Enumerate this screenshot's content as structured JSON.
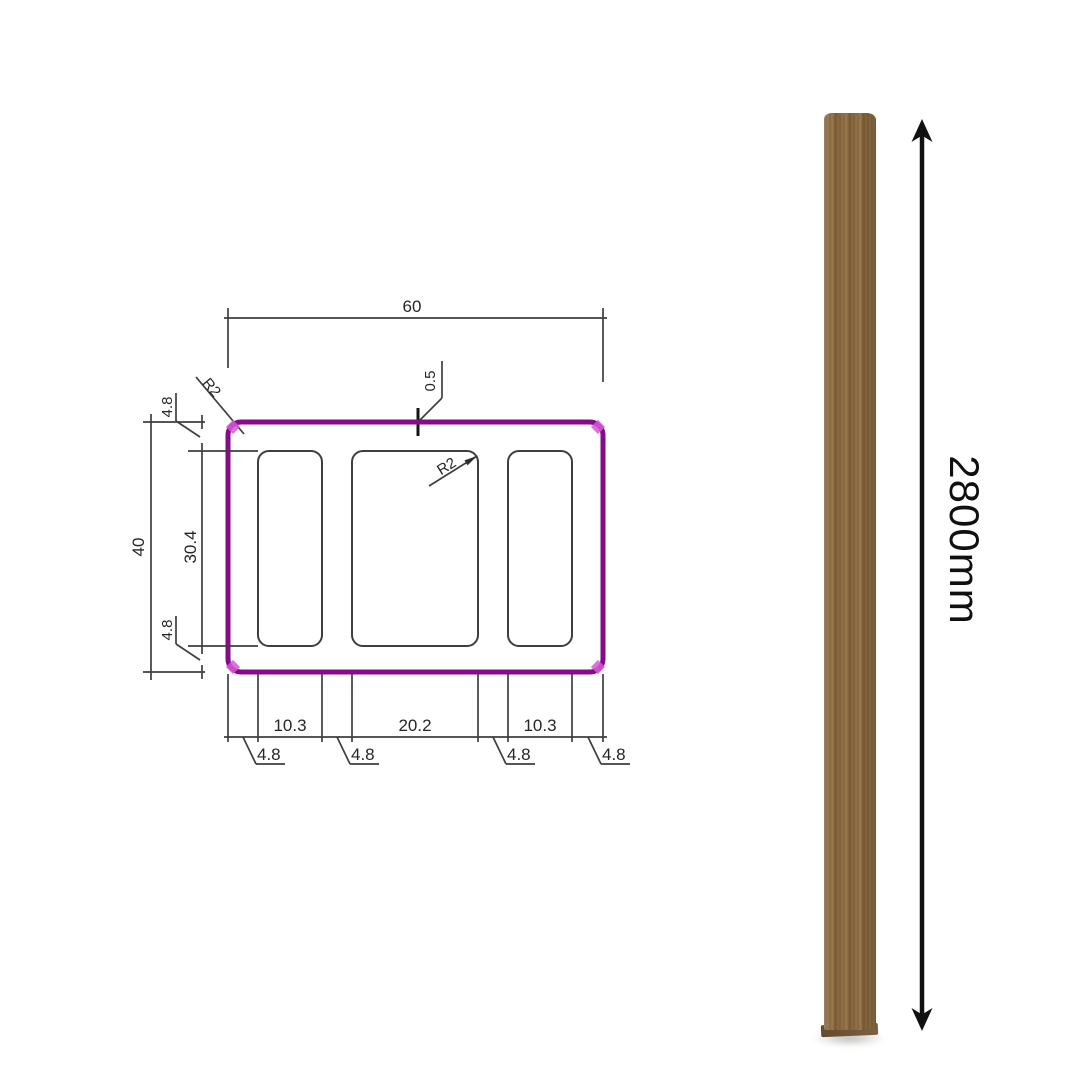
{
  "canvas": {
    "background": "#ffffff"
  },
  "section_drawing": {
    "profile_color": "#860b8a",
    "corner_accent_color": "#d65bd6",
    "line_color": "#3e3e3e",
    "dim_top_width": "60",
    "dim_left_overall": "40",
    "dim_left_inner": "30.4",
    "dim_left_wall_top": "4.8",
    "dim_left_wall_bottom": "4.8",
    "dim_bottom_chambers": [
      "10.3",
      "20.2",
      "10.3"
    ],
    "dim_bottom_walls": [
      "4.8",
      "4.8",
      "4.8",
      "4.8"
    ],
    "callout_outer_radius": "R2",
    "callout_inner_radius": "R2",
    "callout_groove_depth": "0.5"
  },
  "batten_render": {
    "length_label": "2800mm",
    "wood_base_color": "#8c6c43"
  }
}
